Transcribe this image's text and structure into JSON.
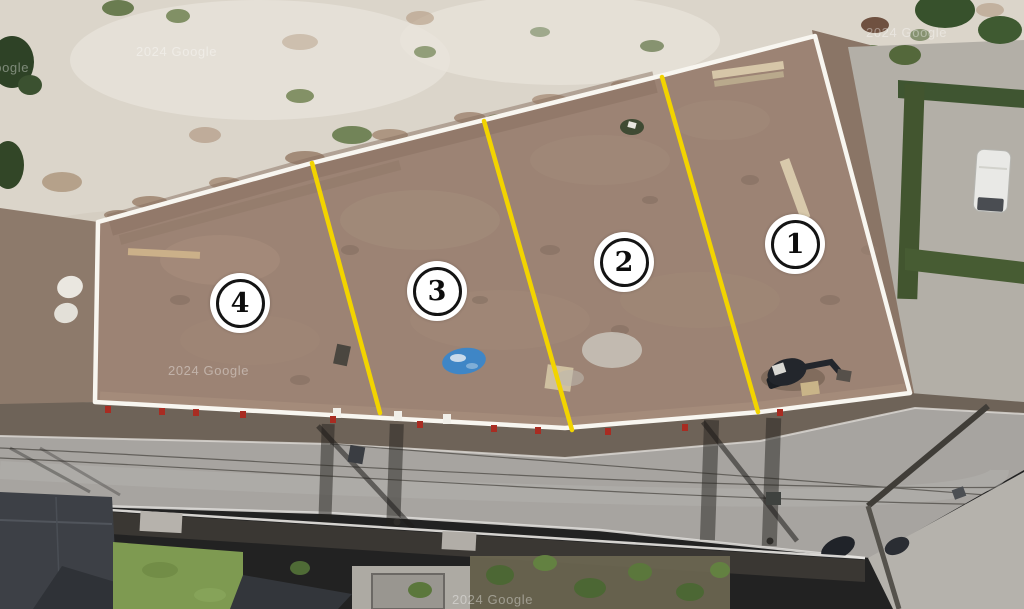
{
  "lot_markers": [
    {
      "number": "1"
    },
    {
      "number": "2"
    },
    {
      "number": "3"
    },
    {
      "number": "4"
    }
  ],
  "watermark": {
    "text": "2024 Google"
  },
  "colors": {
    "divider_yellow": "#f2d400",
    "boundary_white": "#f8f6f0",
    "lot_dirt": "#9c8374",
    "sand": "#dbd5ca",
    "road_gray": "#a7a4a0",
    "tarp_blue": "#3f86c6",
    "marker_bg": "#ffffff",
    "marker_ring": "#141414"
  }
}
